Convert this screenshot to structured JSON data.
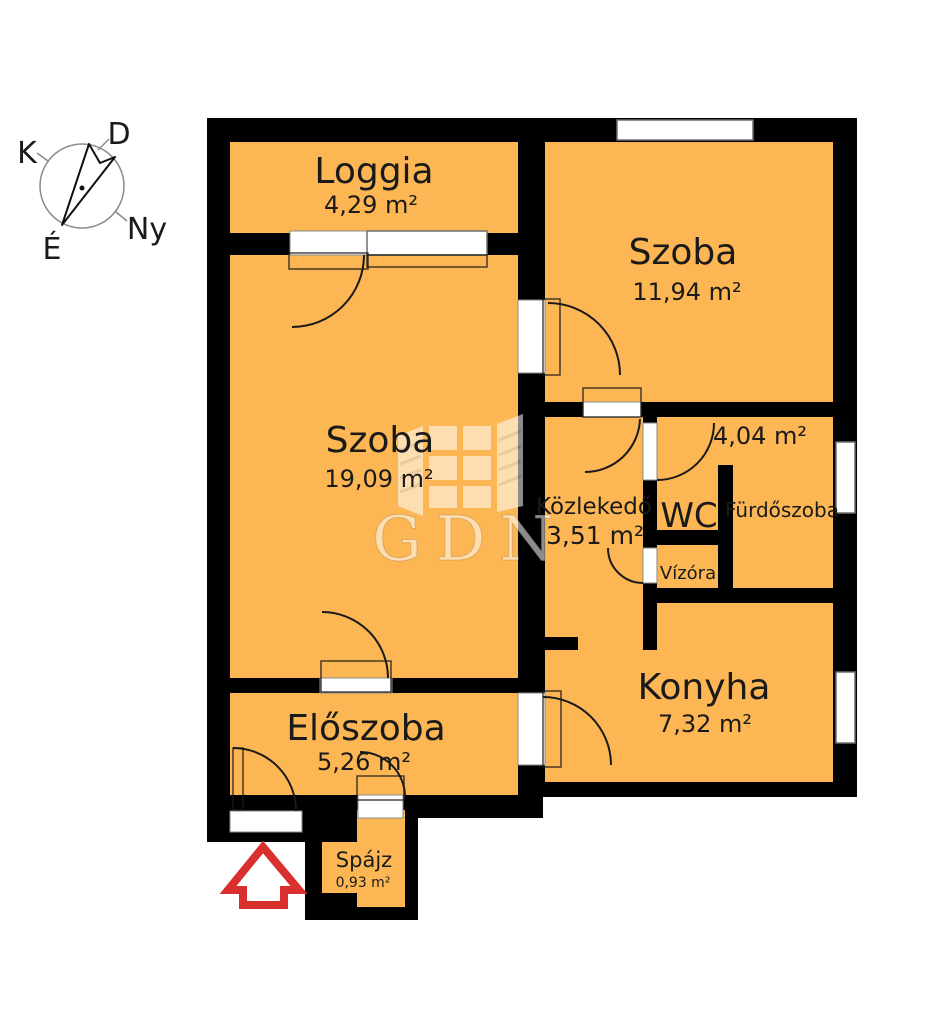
{
  "colors": {
    "room_fill": "#FCB653",
    "wall": "#000000",
    "background": "#FFFFFF",
    "opening": "#FFFFFF",
    "arrow_red": "#D9302E",
    "line": "#1A1A1A"
  },
  "compass": {
    "east_label": "K",
    "south_label": "D",
    "west_label": "Ny",
    "north_label": "É"
  },
  "watermark": {
    "brand": "GDN"
  },
  "rooms": {
    "loggia": {
      "label": "Loggia",
      "area": "4,29 m²"
    },
    "szoba_top": {
      "label": "Szoba",
      "area": "11,94 m²"
    },
    "szoba_left": {
      "label": "Szoba",
      "area": "19,09 m²"
    },
    "kozlekedo": {
      "label": "Közlekedő",
      "area": "3,51 m²"
    },
    "wc": {
      "label": "WC"
    },
    "bath_block": {
      "area": "4,04 m²"
    },
    "furdoszoba": {
      "label": "Fürdőszoba"
    },
    "vizora": {
      "label": "Vízóra"
    },
    "konyha": {
      "label": "Konyha",
      "area": "7,32 m²"
    },
    "eloszoba": {
      "label": "Előszoba",
      "area": "5,26 m²"
    },
    "spajz": {
      "label": "Spájz",
      "area": "0,93 m²"
    }
  }
}
